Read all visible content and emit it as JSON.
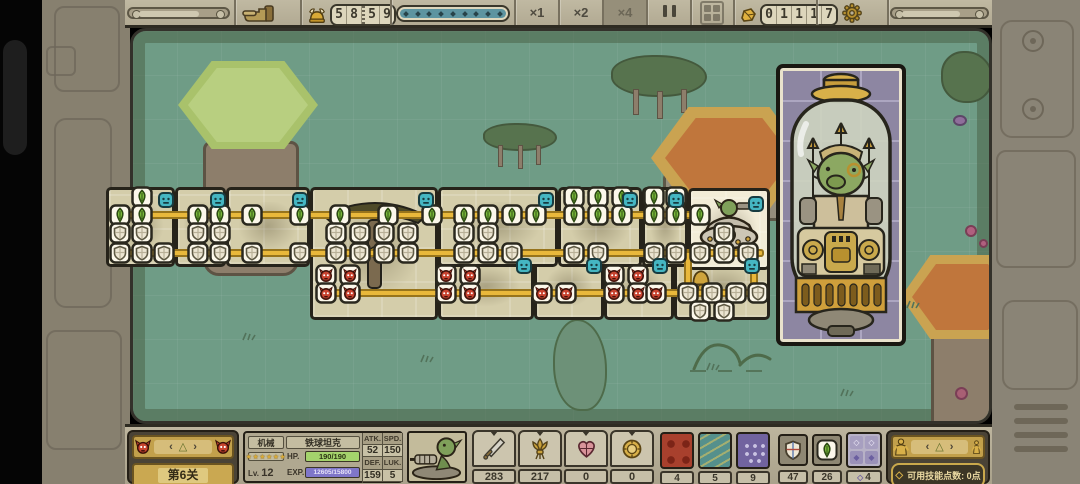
{
  "top_bar": {
    "hand_icon": "hand-cursor-icon",
    "helmet_icon": "helmet-icon",
    "unit_counter": "5859",
    "progress_dots": 9,
    "speed_x1": "×1",
    "speed_x2": "×2",
    "speed_x4": "×4",
    "gold_icon": "gold-nugget-icon",
    "gold_counter": "01117",
    "gear_icon": "gear-icon"
  },
  "chain": {
    "cards": [
      {
        "x": 106,
        "y": 187,
        "w": 69,
        "h": 80
      },
      {
        "x": 175,
        "y": 187,
        "w": 51,
        "h": 80
      },
      {
        "x": 226,
        "y": 187,
        "w": 84,
        "h": 80
      },
      {
        "x": 310,
        "y": 187,
        "w": 128,
        "h": 133
      },
      {
        "x": 438,
        "y": 187,
        "w": 120,
        "h": 80
      },
      {
        "x": 558,
        "y": 187,
        "w": 84,
        "h": 80
      },
      {
        "x": 642,
        "y": 187,
        "w": 46,
        "h": 80
      },
      {
        "x": 688,
        "y": 188,
        "w": 82,
        "h": 82,
        "hl": true
      },
      {
        "x": 438,
        "y": 254,
        "w": 96,
        "h": 66
      },
      {
        "x": 534,
        "y": 254,
        "w": 70,
        "h": 66
      },
      {
        "x": 604,
        "y": 254,
        "w": 70,
        "h": 66
      },
      {
        "x": 674,
        "y": 254,
        "w": 96,
        "h": 66
      }
    ],
    "lines": [
      {
        "x": 112,
        "y": 211,
        "w": 594,
        "h": 8
      },
      {
        "x": 112,
        "y": 249,
        "w": 652,
        "h": 8
      },
      {
        "x": 318,
        "y": 289,
        "w": 446,
        "h": 8
      },
      {
        "x": 684,
        "y": 251,
        "w": 8,
        "h": 46
      },
      {
        "x": 750,
        "y": 251,
        "w": 8,
        "h": 46
      }
    ],
    "nodes": [
      {
        "t": "gem",
        "y": 197,
        "xs": [
          142,
          574,
          598,
          622,
          654,
          676
        ]
      },
      {
        "t": "gem",
        "y": 215,
        "xs": [
          120,
          142,
          198,
          220,
          252,
          300,
          340,
          388,
          432,
          464,
          488,
          512,
          536,
          574,
          598,
          622,
          654,
          676,
          700
        ]
      },
      {
        "t": "shield",
        "y": 233,
        "xs": [
          120,
          142,
          198,
          220,
          336,
          360,
          384,
          408,
          464,
          488,
          724
        ]
      },
      {
        "t": "shield",
        "y": 253,
        "xs": [
          120,
          142,
          164,
          198,
          220,
          252,
          300,
          336,
          360,
          384,
          408,
          464,
          488,
          512,
          574,
          598,
          654,
          676,
          700,
          724,
          748
        ]
      },
      {
        "t": "demon",
        "y": 275,
        "xs": [
          326,
          350,
          446,
          470,
          614,
          638
        ]
      },
      {
        "t": "demon",
        "y": 293,
        "xs": [
          326,
          350,
          446,
          470,
          542,
          566,
          614,
          638,
          656
        ]
      },
      {
        "t": "shield",
        "y": 293,
        "xs": [
          688,
          712,
          736,
          758
        ]
      },
      {
        "t": "shield",
        "y": 311,
        "xs": [
          700,
          724
        ]
      }
    ],
    "badges": [
      [
        158,
        192
      ],
      [
        210,
        192
      ],
      [
        292,
        192
      ],
      [
        418,
        192
      ],
      [
        538,
        192
      ],
      [
        622,
        192
      ],
      [
        668,
        192
      ],
      [
        748,
        196
      ],
      [
        516,
        258
      ],
      [
        586,
        258
      ],
      [
        652,
        258
      ],
      [
        744,
        258
      ],
      [
        886,
        72
      ]
    ]
  },
  "boss_card": {
    "icon": "goblin-capsule-boss"
  },
  "bottom_bar": {
    "level_panel": {
      "prev_icon": "demon-head-icon",
      "next_icon": "demon-head-icon",
      "chevron_left": "‹",
      "chevron_right": "›",
      "selector": "△",
      "level_label": "第6关"
    },
    "unit_panel": {
      "class_label": "机械",
      "unit_name": "铁球坦克",
      "stars": "★★★★★★",
      "hp_label": "HP.",
      "hp_value": "190/190",
      "lv_label": "Lv.",
      "lv_value": "12",
      "exp_label": "EXP.",
      "exp_value": "12605/15800",
      "stats": [
        {
          "label": "ATK.",
          "value": "52"
        },
        {
          "label": "SPD.",
          "value": "150"
        },
        {
          "label": "DEF.",
          "value": "159"
        },
        {
          "label": "LUK.",
          "value": "5"
        }
      ],
      "portrait_icon": "goblin-cannon-portrait"
    },
    "resource_counters": [
      {
        "icon": "sword-icon",
        "value": "283"
      },
      {
        "icon": "bouquet-icon",
        "value": "217"
      },
      {
        "icon": "heart-icon",
        "value": "0"
      },
      {
        "icon": "medal-icon",
        "value": "0"
      }
    ],
    "deck_cards": [
      {
        "icon": "red-demon-card",
        "count": "4"
      },
      {
        "icon": "teal-fish-card",
        "count": "5"
      },
      {
        "icon": "purple-dot-card",
        "count": "9"
      }
    ],
    "item_slots": [
      {
        "icon": "shield-icon",
        "value": "47"
      },
      {
        "icon": "leaf-gem-icon",
        "value": "26"
      },
      {
        "icon": "diamond-grid-icon",
        "prefix": "◇",
        "value": "4"
      }
    ],
    "skill_panel": {
      "left_icon": "hero-figure-icon",
      "right_icon": "slim-figure-icon",
      "chevron_left": "‹",
      "chevron_right": "›",
      "selector": "△",
      "diamond": "◇",
      "text": "可用技能点数: 0点"
    }
  }
}
